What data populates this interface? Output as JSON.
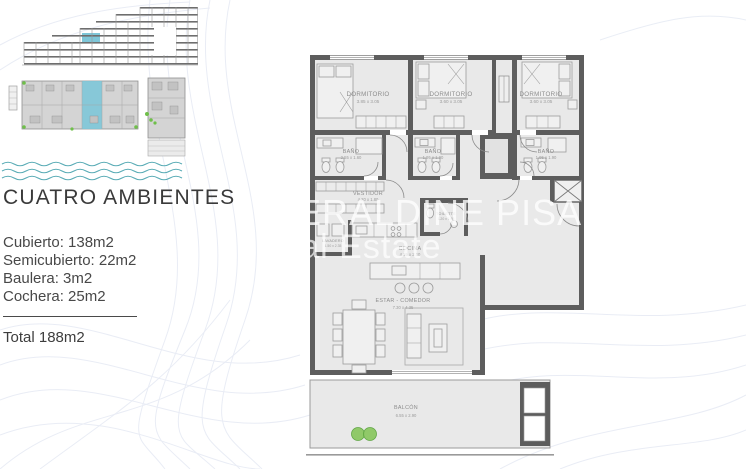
{
  "left_panel": {
    "title": "CUATRO AMBIENTES",
    "specs": [
      "Cubierto: 138m2",
      "Semicubierto: 22m2",
      "Baulera: 3m2",
      "Cochera: 25m2"
    ],
    "total": "Total 188m2"
  },
  "watermark": {
    "line1": "GERALDINE PISANO",
    "line2": "real Estate"
  },
  "floor_plan": {
    "bedroom1": {
      "name": "DORMITORIO",
      "dims": "3.85 x 3.05"
    },
    "bedroom2": {
      "name": "DORMITORIO",
      "dims": "3.60 x 3.05"
    },
    "bedroom3": {
      "name": "DORMITORIO",
      "dims": "3.60 x 3.05"
    },
    "bath1": {
      "name": "BAÑO",
      "dims": "2.55 x 1.60"
    },
    "bath2": {
      "name": "BAÑO",
      "dims": "1.95 x 1.90"
    },
    "bath3": {
      "name": "BAÑO",
      "dims": "1.95 x 1.90"
    },
    "vestidor": {
      "name": "VESTIDOR",
      "dims": "4.20 x 1.80"
    },
    "toilette": {
      "name": "TOILETTE",
      "dims": "1.20 x 1.65"
    },
    "lavadero": {
      "name": "LAVADERO",
      "dims": "1.50 x 2.35"
    },
    "cocina": {
      "name": "COCINA",
      "dims": "4.55 x 2.10"
    },
    "estar": {
      "name": "ESTAR - COMEDOR",
      "dims": "7.30 x 4.35"
    },
    "balcon": {
      "name": "BALCÓN",
      "dims": "6.55 x 2.90"
    }
  },
  "colors": {
    "accent_cyan": "#7ec6d8",
    "wave_teal": "#5aacb6",
    "wall_gray": "#5d5d5d",
    "floor_gray": "#e9e9e9",
    "plant_green": "#8cc863"
  }
}
